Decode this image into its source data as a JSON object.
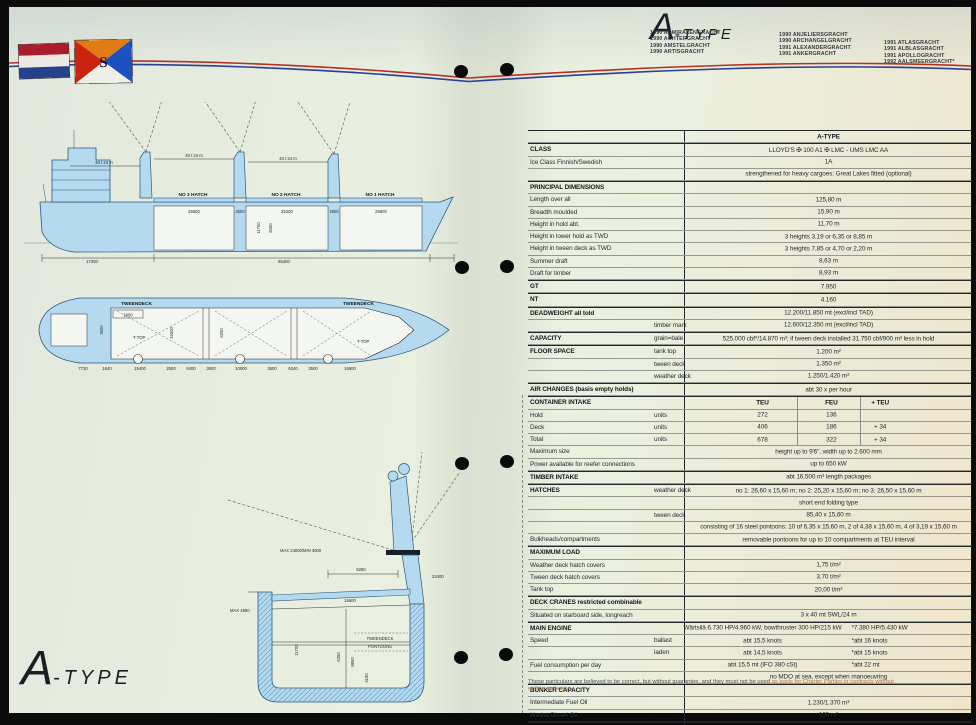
{
  "header": {
    "logo_a": "A",
    "logo_suffix": "-TYPE",
    "fleet": [
      [
        "1990 ADMIRALENGRACHT",
        "1990 ACHTERGRACHT",
        "1990 AMSTELGRACHT",
        "1990 ARTISGRACHT"
      ],
      [
        "1990 ANJELIERSGRACHT",
        "1990 ARCHANGELGRACHT",
        "1991 ALEXANDERGRACHT",
        "1991 ANKERGRACHT"
      ],
      [
        "1991 ATLASGRACHT",
        "1991 ALBLASGRACHT",
        "1991 APOLLOGRACHT",
        "1992 AALSMEERGRACHT*"
      ]
    ]
  },
  "flags": {
    "house_letter": "S",
    "nl_red": "#a91d2c",
    "nl_white": "#ece9e4",
    "nl_blue": "#23418d",
    "house_orange": "#e07b15",
    "house_red": "#cc2310",
    "house_blue": "#1c52c0",
    "house_white": "#efefe8"
  },
  "footer_logo": {
    "a": "A",
    "suffix": "-TYPE"
  },
  "table": {
    "rows": [
      {
        "sec": 1,
        "v": "A-TYPE",
        "vb": 1
      },
      {
        "sec": 1,
        "lb": 1,
        "label": "CLASS",
        "v": "LLOYD'S ✠ 100 A1 ✠ LMC - UMS LMC AA"
      },
      {
        "label": "Ice Class Finnish/Swedish",
        "v": "1A"
      },
      {
        "v": "strengthened for heavy cargoes; Great Lakes fitted (optional)"
      },
      {
        "sec": 1,
        "lb": 1,
        "label": "PRINCIPAL DIMENSIONS"
      },
      {
        "label": "Length over all",
        "v": "125,80 m"
      },
      {
        "label": "Breadth moulded",
        "v": "15,90 m"
      },
      {
        "label": "Height in hold abt.",
        "v": "11,70 m"
      },
      {
        "label": "Height in lower hold as TWD",
        "v": "3 heights 3,19 or 6,35 or 8,85 m"
      },
      {
        "label": "Height in tween deck as TWD",
        "v": "3 heights 7,85 or 4,70 or 2,20 m"
      },
      {
        "label": "Summer draft",
        "v": "8,63 m"
      },
      {
        "label": "Draft for timber",
        "v": "8,93 m"
      },
      {
        "sec": 1,
        "lb": 1,
        "label": "GT",
        "v": "7.950"
      },
      {
        "sec": 1,
        "lb": 1,
        "label": "NT",
        "v": "4.160"
      },
      {
        "sec": 1,
        "lb": 1,
        "label": "DEADWEIGHT all told",
        "v": "12.200/11.850 mt (excl/incl TAD)"
      },
      {
        "sub": "timber mark",
        "v": "12.600/12.350 mt (excl/incl TAD)"
      },
      {
        "sec": 1,
        "lb": 1,
        "label": "CAPACITY",
        "sub": "grain=bale",
        "v": "525.000 cbf*/14.870 m³; if tween deck installed 31.750 cbf/900 m³ less in hold"
      },
      {
        "sec": 1,
        "lb": 1,
        "label": "FLOOR SPACE",
        "sub": "tank top",
        "v": "1.200 m²"
      },
      {
        "sub": "tween deck",
        "v": "1.350 m²"
      },
      {
        "sub": "weather deck",
        "v": "1.250/1.420 m²"
      },
      {
        "sec": 1,
        "lb": 1,
        "label": "AIR CHANGES (basis empty holds)",
        "v": "abt 30 x per hour"
      },
      {
        "sec": 1,
        "lb": 1,
        "label": "CONTAINER INTAKE",
        "cols": [
          "TEU",
          "FEU",
          "+ TEU"
        ]
      },
      {
        "label": "Hold",
        "sub": "units",
        "cols": [
          "272",
          "136",
          ""
        ]
      },
      {
        "label": "Deck",
        "sub": "units",
        "cols": [
          "406",
          "186",
          "+ 34"
        ]
      },
      {
        "label": "Total",
        "sub": "units",
        "cols": [
          "678",
          "322",
          "+ 34"
        ]
      },
      {
        "label": "Maximum size",
        "v": "height up to 9'6'', width up to 2.600 mm"
      },
      {
        "label": "Power available for reefer connections",
        "v": "up to 650 kW"
      },
      {
        "sec": 1,
        "lb": 1,
        "label": "TIMBER INTAKE",
        "v": "abt 16.500 m³ length packages"
      },
      {
        "sec": 1,
        "lb": 1,
        "label": "HATCHES",
        "sub": "weather deck",
        "v": "no 1: 26,60 x 15,60 m; no 2: 25,20 x 15,60 m; no 3: 26,50 x 15,60 m"
      },
      {
        "v": "short end folding type"
      },
      {
        "sub": "tween deck",
        "v": "85,40 x 15,60 m"
      },
      {
        "v": "consisting of 16 steel pontoons: 10 of 6,35 x 15,60 m, 2 of 4,38 x 15,60 m, 4 of 3,19 x 15,60 m"
      },
      {
        "label": "Bulkheads/compartments",
        "v": "removable pontoons for up to 10 compartments at TEU interval"
      },
      {
        "sec": 1,
        "lb": 1,
        "label": "MAXIMUM LOAD"
      },
      {
        "label": "Weather deck hatch covers",
        "v": "1,75 t/m²"
      },
      {
        "label": "Tween deck hatch covers",
        "v": "3,70 t/m²"
      },
      {
        "label": "Tank top",
        "v": "20,00 t/m²"
      },
      {
        "sec": 1,
        "lb": 1,
        "label": "DECK CRANES restricted combinable"
      },
      {
        "label": "Situated on starboard side, longreach",
        "v": "3 x 40 mt SWL/24 m"
      },
      {
        "sec": 1,
        "lb": 1,
        "label": "MAIN ENGINE",
        "v": "Wärtsilä 6.730 HP/4.960 kW, bowthruster 300 HP/215 kW",
        "v2": "*7.380 HP/5.430 kW"
      },
      {
        "label": "Speed",
        "sub": "ballast",
        "v": "abt 15,5 knots",
        "v2": "*abt 16 knots"
      },
      {
        "sub": "laden",
        "v": "abt 14,5 knots",
        "v2": "*abt 15 knots"
      },
      {
        "label": "Fuel consumption per day",
        "v": "abt 15,5 mt (IFO 380 cSt)",
        "v2": "*abt 22 mt"
      },
      {
        "v": "no MDO at sea, except when manoeuvring"
      },
      {
        "sec": 1,
        "lb": 1,
        "label": "BUNKER CAPACITY"
      },
      {
        "label": "Intermediate Fuel Oil",
        "v": "1.230/1.370 m³"
      },
      {
        "label": "Marine Diesel Oil",
        "v": "105 m³"
      },
      {
        "sec": 1,
        "lb": 1,
        "label": "BALLAST CAPACITY",
        "v": "4.500 m³"
      }
    ]
  },
  "footnote": {
    "part1": "These particulars are believed to be correct, but without guarantee, and they must not be used",
    "part2": " as basis for Charter Parties or contracts without",
    "line2": "written authority."
  },
  "drawings": {
    "profile": {
      "h3": "NO 3 HATCH",
      "h2": "NO 2 HATCH",
      "h1": "NO 1 HATCH",
      "crane": "40 t 24 m",
      "d1": "26500",
      "d2": "2500",
      "d3": "25200",
      "d4": "2500",
      "d5": "26600",
      "d6": "17200",
      "d7": "85400",
      "v1": "11700",
      "v2": "8450"
    },
    "plan": {
      "tweendeck": "TWEENDECK",
      "ttop": "T-TOP",
      "d1900": "1900",
      "d3600": "3600",
      "d15600": "15600",
      "d6250": "6250",
      "dims": [
        "7730",
        "1640",
        "15400",
        "2500",
        "6400",
        "3600",
        "10000",
        "3600",
        "6340",
        "3500",
        "16800"
      ]
    },
    "section": {
      "max_reach": "MAX 24000/MIN 3600",
      "d6250": "6250",
      "d23400": "23400",
      "d15600": "15600",
      "tweendeck": "TWEENDECK",
      "pontoons": "PONTOONS",
      "d11700": "11700",
      "d6350": "6350",
      "d8850": "8850",
      "d3190": "3190",
      "max4950": "MAX 4950"
    }
  }
}
